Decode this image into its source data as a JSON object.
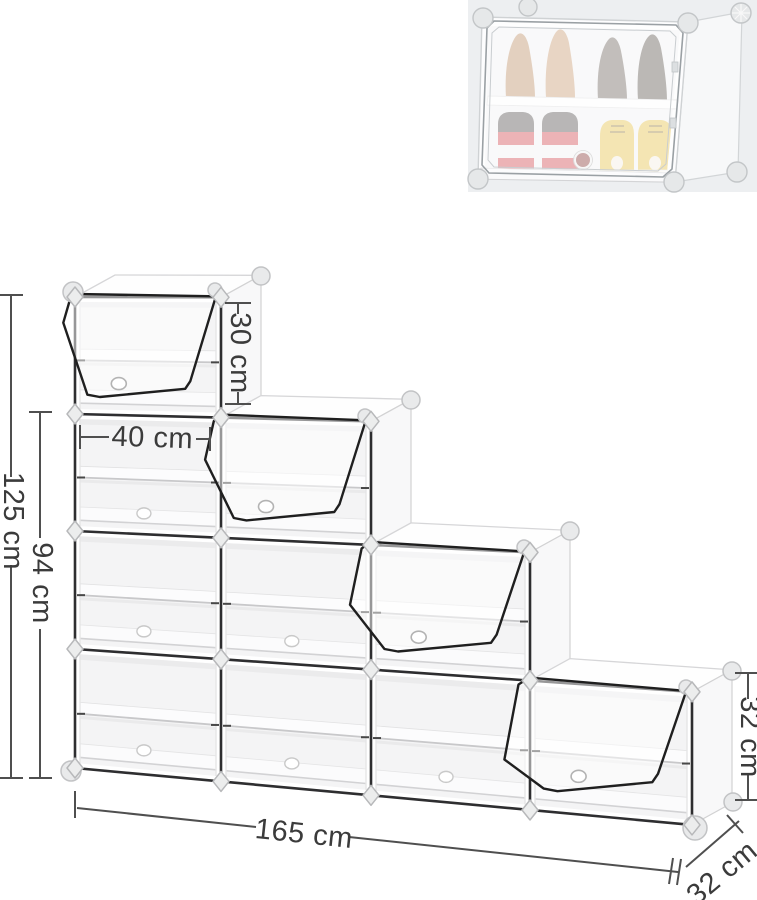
{
  "image": {
    "type": "product-dimension-diagram",
    "product": "modular cube shoe rack organizer",
    "background": "#ffffff"
  },
  "dimensions": {
    "top_cube_height": "30 cm",
    "cube_width": "40 cm",
    "three_tier_height": "94 cm",
    "total_height": "125 cm",
    "total_width": "165 cm",
    "right_cube_height": "32 cm",
    "depth": "32 cm"
  },
  "figure": {
    "steps": [
      4,
      3,
      2,
      1
    ],
    "shelves_per_cube": 1,
    "open_door_on_top_cube_of_each_step": true,
    "colors": {
      "frame_line": "#2e2e30",
      "door_line": "#1f1f1f",
      "dim_line": "#4f4f4f",
      "dim_text": "#3b3b3b",
      "connector_fill": "#eceded",
      "connector_stroke": "#b7b8ba",
      "face_white": "#fefefe",
      "side_face": "#f8f8f9",
      "interior_back": "#f4f4f5"
    }
  },
  "inset": {
    "position": "top-right",
    "compartments": 2,
    "contents": [
      {
        "shelf": "top",
        "items": [
          "beige high heels",
          "dark mesh high heels"
        ]
      },
      {
        "shelf": "bottom",
        "items": [
          "red-white high-top sneakers",
          "yellow sneakers"
        ]
      }
    ],
    "colors": {
      "backdrop": "#edeff1",
      "heel_beige_1": "#bd9069",
      "heel_beige_2": "#c89b73",
      "heel_dark_1": "#6e665f",
      "heel_dark_2": "#5d564f",
      "sneaker_red": "#d14a52",
      "sneaker_collar": "#565351",
      "sneaker_yellow": "#e5c24c",
      "badge": "#8a3a38",
      "sole_white": "#fbfbfc"
    }
  }
}
